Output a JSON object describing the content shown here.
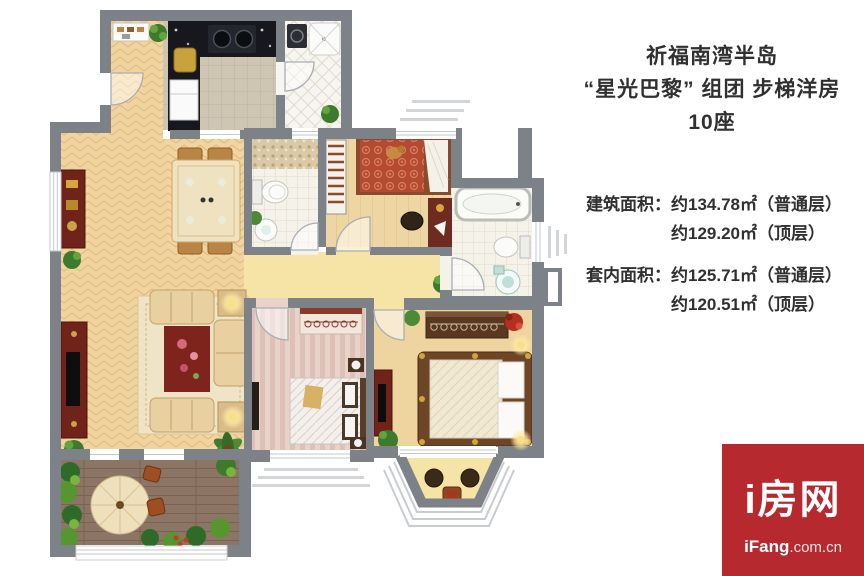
{
  "info_panel": {
    "title_line1": "祈福南湾半岛",
    "title_line2": "“星光巴黎” 组团 步梯洋房",
    "title_line3": "10座",
    "building_area": {
      "label": "建筑面积：",
      "line1": "约134.78㎡（普通层）",
      "line2": "约129.20㎡（顶层）"
    },
    "inner_area": {
      "label": "套内面积：",
      "line1": "约125.71㎡（普通层）",
      "line2": "约120.51㎡（顶层）"
    }
  },
  "logo": {
    "name": "i房网",
    "domain_bold": "iFang",
    "domain_rest": ".com.cn",
    "background_color": "#b5292f"
  },
  "palette": {
    "wall_gray": "#7d8288",
    "living_floor_tan": "#f2d59e",
    "terrace_deck_brown": "#8d7565",
    "logo_red": "#b5292f"
  }
}
